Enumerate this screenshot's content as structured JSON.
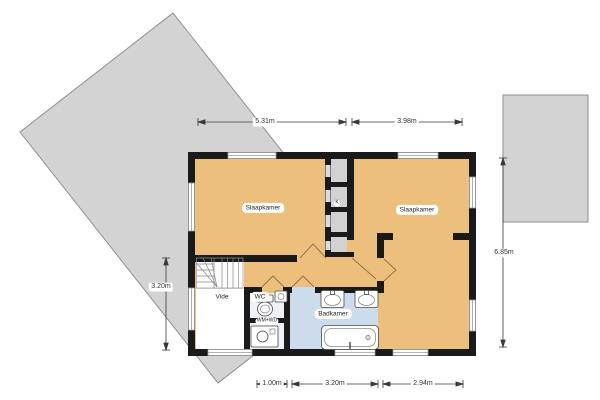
{
  "plan": {
    "type": "floorplan",
    "language": "nl",
    "rooms": {
      "bedroom_left": {
        "label": "Slaapkamer"
      },
      "bedroom_right": {
        "label": "Slaapkamer"
      },
      "bathroom": {
        "label": "Badkamer"
      },
      "toilet": {
        "label": "WC"
      },
      "void": {
        "label": "Vide"
      },
      "closet": {
        "label": "K"
      },
      "laundry": {
        "label": "WM+WD"
      }
    },
    "dimensions": {
      "top": [
        {
          "label": "5.31m"
        },
        {
          "label": "3.98m"
        }
      ],
      "bottom": [
        {
          "label": "1.00m"
        },
        {
          "label": "3.20m"
        },
        {
          "label": "2.94m"
        }
      ],
      "left": {
        "label": "3.20m"
      },
      "right": {
        "label": "6.85m"
      }
    },
    "fixtures": [
      "stairs",
      "toilet",
      "hand-sink",
      "washing-machine",
      "sink",
      "sink",
      "bathtub"
    ],
    "palette": {
      "floor_orange": "#ecbf7d",
      "bathroom_blue": "#cddcec",
      "service_light": "#eef2f7",
      "roof_gray": "#d3d3d3",
      "closet_gray": "#d2d2d2",
      "wall_black": "#1a1a1a",
      "door_swing": "#96734a"
    }
  }
}
